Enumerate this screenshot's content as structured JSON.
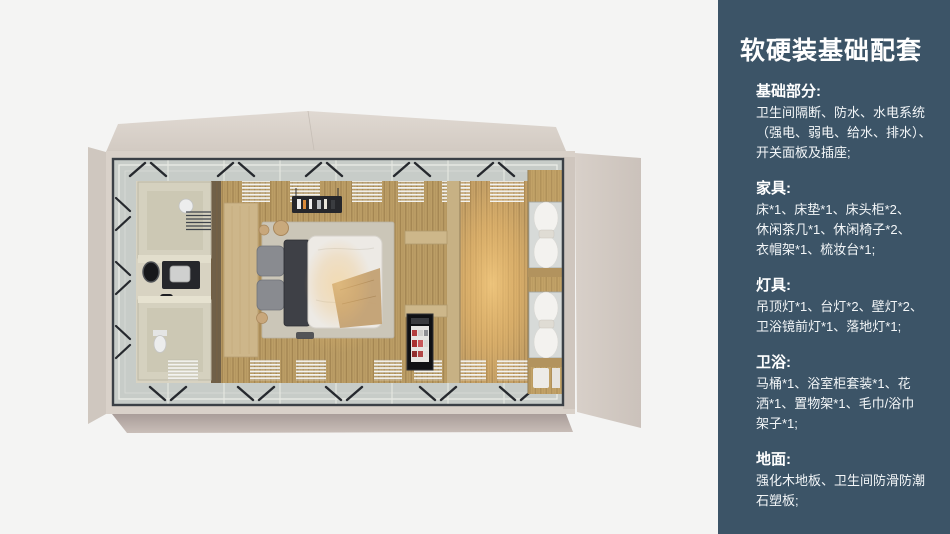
{
  "panel": {
    "background_color": "#3c5467",
    "text_color": "#ffffff",
    "title": "软硬装基础配套",
    "sections": [
      {
        "title": "基础部分:",
        "lines": [
          "卫生间隔断、防水、水电系统",
          "（强电、弱电、给水、排水）、",
          "开关面板及插座;"
        ]
      },
      {
        "title": "家具:",
        "lines": [
          "床*1、床垫*1、床头柜*2、",
          "休闲茶几*1、休闲椅子*2、",
          "衣帽架*1、梳妆台*1;"
        ]
      },
      {
        "title": "灯具:",
        "lines": [
          "吊顶灯*1、台灯*2、壁灯*2、",
          "卫浴镜前灯*1、落地灯*1;"
        ]
      },
      {
        "title": "卫浴:",
        "lines": [
          "马桶*1、浴室柜套装*1、花",
          "洒*1、置物架*1、毛巾/浴巾",
          "架子*1;"
        ]
      },
      {
        "title": "地面:",
        "lines": [
          "强化木地板、卫生间防滑防潮",
          "石塑板;"
        ]
      }
    ]
  },
  "illustration": {
    "colors": {
      "background": "#f4f4f3",
      "shell_beige": "#d9d1c9",
      "frame_dark": "#3b4046",
      "glass_ring": "#c7ccc8",
      "wood_floor": "#bc9e66",
      "warm_glow": "#f7cd82",
      "bathroom_pod": "#d5d1bf"
    }
  }
}
